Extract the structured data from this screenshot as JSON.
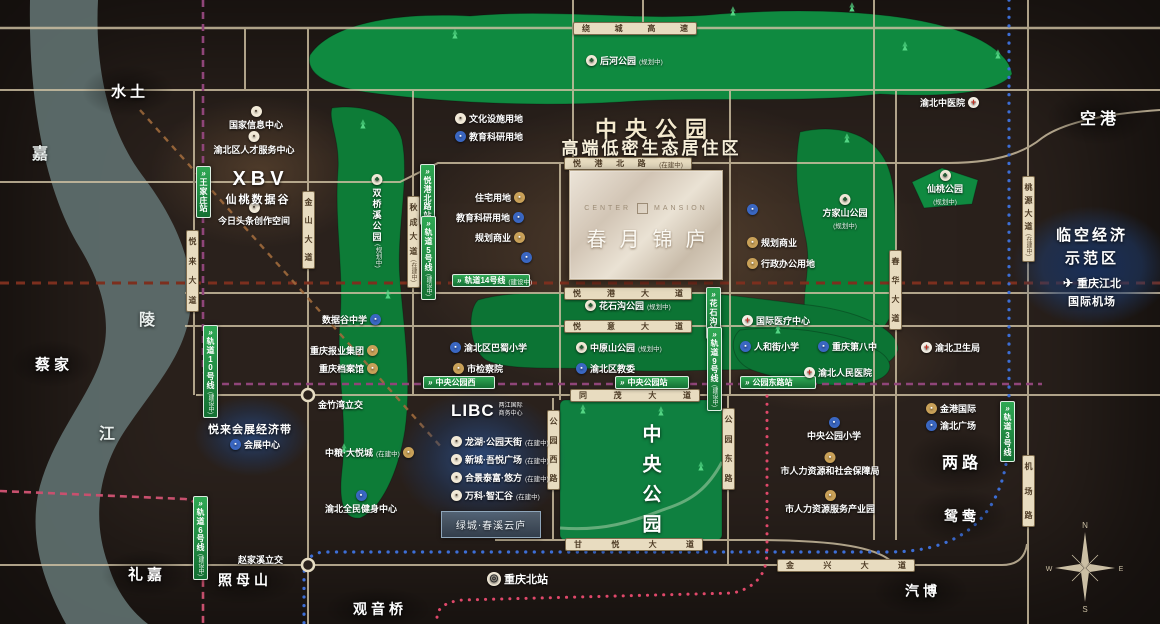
{
  "colors": {
    "background": "#2a211c",
    "road": "#cfc1a3",
    "road_label_bg": "#e8dcc0",
    "park_green": "#0d7c37",
    "park_green_bright": "#0f8a40",
    "river": "#5d6d6c",
    "metro_label_green": "#1d8a43",
    "line10_purple": "#8f4579",
    "line14_darkred": "#7c2f1e",
    "line6_pink": "#c8506e",
    "line3_blue": "#3d6ed6",
    "line9_red": "#e0486a",
    "construction_dash": "#a06a3c",
    "icon_blue": "#3a67c2",
    "icon_tan": "#c9a158",
    "zone_blue": "#2c508a",
    "cream": "#f3e8cd"
  },
  "headline": {
    "line1": "中央公园",
    "line2": "高端低密生态居住区"
  },
  "property": {
    "en_left": "CENTER",
    "en_right": "MANSION",
    "cn": "春月锦庐"
  },
  "xbv": {
    "title": "XBV",
    "subtitle": "仙桃数据谷"
  },
  "libc": {
    "title": "LIBC",
    "sub1": "两江国际",
    "sub2": "商务中心",
    "box": "绿城·春溪云庐",
    "items": [
      {
        "label": "龙湖·公园天街",
        "status": "(在建中)"
      },
      {
        "label": "新城·吾悦广场",
        "status": "(在建中)"
      },
      {
        "label": "合景泰富·悠方",
        "status": "(在建中)"
      },
      {
        "label": "万科·智汇谷",
        "status": "(在建中)"
      }
    ]
  },
  "linkong": {
    "line1": "临空经济",
    "line2": "示范区",
    "airport1": "重庆江北",
    "airport2": "国际机场"
  },
  "yuelai": {
    "title": "悦来会展经济带"
  },
  "central_park_title": "中央公园",
  "compass": {
    "n": "N",
    "s": "S",
    "e": "E",
    "w": "W"
  },
  "map": {
    "places": [
      {
        "t": "水土",
        "x": 128,
        "y": 91,
        "fs": 15,
        "hw": 92,
        "hh": 52
      },
      {
        "t": "蔡家",
        "x": 52,
        "y": 364,
        "fs": 15,
        "hw": 84,
        "hh": 48
      },
      {
        "t": "礼嘉",
        "x": 145,
        "y": 574,
        "fs": 15,
        "hw": 88,
        "hh": 48
      },
      {
        "t": "照母山",
        "x": 243,
        "y": 580,
        "fs": 14,
        "hw": 110,
        "hh": 50
      },
      {
        "t": "观音桥",
        "x": 378,
        "y": 609,
        "fs": 14,
        "hw": 108,
        "hh": 44
      },
      {
        "t": "空港",
        "x": 1098,
        "y": 117,
        "fs": 16,
        "hw": 104,
        "hh": 56
      },
      {
        "t": "两路",
        "x": 960,
        "y": 461,
        "fs": 16,
        "hw": 108,
        "hh": 64
      },
      {
        "t": "鸳鸯",
        "x": 960,
        "y": 516,
        "fs": 14,
        "hw": 96,
        "hh": 56
      },
      {
        "t": "汽博",
        "x": 921,
        "y": 591,
        "fs": 14,
        "hw": 96,
        "hh": 50
      }
    ],
    "river_chars": [
      {
        "t": "嘉",
        "x": 40,
        "y": 152
      },
      {
        "t": "陵",
        "x": 147,
        "y": 318
      },
      {
        "t": "江",
        "x": 107,
        "y": 432
      }
    ],
    "roads_h": [
      {
        "t": "绕城高速",
        "x": 573,
        "y": 22,
        "w": 124
      },
      {
        "t": "悦港北路",
        "x": 564,
        "y": 157,
        "w": 128,
        "sub": "(在建中)"
      },
      {
        "t": "悦港大道",
        "x": 564,
        "y": 287,
        "w": 128
      },
      {
        "t": "悦意大道",
        "x": 564,
        "y": 320,
        "w": 128
      },
      {
        "t": "同茂大道",
        "x": 570,
        "y": 389,
        "w": 130
      },
      {
        "t": "甘悦大道",
        "x": 565,
        "y": 538,
        "w": 138
      },
      {
        "t": "金兴大道",
        "x": 777,
        "y": 559,
        "w": 138
      }
    ],
    "roads_v": [
      {
        "t": "悦来大道",
        "x": 186,
        "y": 230,
        "h": 82
      },
      {
        "t": "金山大道",
        "x": 302,
        "y": 191,
        "h": 78
      },
      {
        "t": "秋成大道",
        "x": 407,
        "y": 196,
        "h": 92,
        "sub": "(在建中)"
      },
      {
        "t": "春华大道",
        "x": 889,
        "y": 250,
        "h": 80
      },
      {
        "t": "桃源大道",
        "x": 1022,
        "y": 176,
        "h": 86,
        "sub": "(在建中)"
      },
      {
        "t": "机场路",
        "x": 1022,
        "y": 455,
        "h": 72
      },
      {
        "t": "公园西路",
        "x": 547,
        "y": 410,
        "h": 80
      },
      {
        "t": "公园东路",
        "x": 722,
        "y": 408,
        "h": 82
      }
    ],
    "metro_h": [
      {
        "t": "轨道14号线",
        "x": 452,
        "y": 274,
        "w": 78,
        "sub": "(建设中)"
      },
      {
        "t": "中央公园西",
        "x": 423,
        "y": 376,
        "w": 72
      },
      {
        "t": "中央公园站",
        "x": 615,
        "y": 376,
        "w": 74
      },
      {
        "t": "公园东路站",
        "x": 740,
        "y": 376,
        "w": 76
      }
    ],
    "metro_v": [
      {
        "t": "王家庄站",
        "x": 196,
        "y": 166,
        "h": 46
      },
      {
        "t": "轨道10号线",
        "x": 203,
        "y": 325,
        "h": 50,
        "sub": "(建设中)"
      },
      {
        "t": "悦港北路站",
        "x": 420,
        "y": 164,
        "h": 46
      },
      {
        "t": "轨道5号线",
        "x": 421,
        "y": 216,
        "h": 50,
        "sub": "(建设中)"
      },
      {
        "t": "花石沟站",
        "x": 706,
        "y": 287,
        "h": 42
      },
      {
        "t": "轨道9号线",
        "x": 707,
        "y": 327,
        "h": 46,
        "sub": "(建设中)"
      },
      {
        "t": "轨道6号线",
        "x": 193,
        "y": 496,
        "h": 50,
        "sub": "(建设中)"
      },
      {
        "t": "轨道3号线",
        "x": 1000,
        "y": 401,
        "h": 44
      }
    ],
    "pois": [
      {
        "t": "国家信息中心",
        "x": 256,
        "y": 106,
        "i": "w",
        "s": "top"
      },
      {
        "t": "渝北区人才服务中心",
        "x": 254,
        "y": 131,
        "i": "w",
        "s": "top"
      },
      {
        "t": "今日头条创作空间",
        "x": 254,
        "y": 202,
        "i": "w",
        "s": "top"
      },
      {
        "t": "文化设施用地",
        "x": 455,
        "y": 112,
        "i": "w"
      },
      {
        "t": "教育科研用地",
        "x": 455,
        "y": 130,
        "i": "b"
      },
      {
        "t": "住宅用地",
        "x": 475,
        "y": 191,
        "i": "t",
        "s": "right"
      },
      {
        "t": "教育科研用地",
        "x": 456,
        "y": 211,
        "i": "b",
        "s": "right"
      },
      {
        "t": "规划商业",
        "x": 475,
        "y": 231,
        "i": "t",
        "s": "right"
      },
      {
        "t": "",
        "x": 521,
        "y": 251,
        "i": "b"
      },
      {
        "t": "",
        "x": 587,
        "y": 260,
        "i": "b"
      },
      {
        "t": "住宅用地",
        "x": 640,
        "y": 260,
        "i": "t",
        "s": "right"
      },
      {
        "t": "",
        "x": 747,
        "y": 203,
        "i": "b"
      },
      {
        "t": "规划商业",
        "x": 747,
        "y": 236,
        "i": "t"
      },
      {
        "t": "行政办公用地",
        "x": 747,
        "y": 257,
        "i": "t"
      },
      {
        "t": "渝北中医院",
        "x": 920,
        "y": 96,
        "i": "r",
        "s": "right"
      },
      {
        "t": "后河公园",
        "x": 586,
        "y": 54,
        "i": "p",
        "sub": "(规划中)"
      },
      {
        "t": "花石沟公园",
        "x": 585,
        "y": 299,
        "i": "p",
        "sub": "(规划中)"
      },
      {
        "t": "中原山公园",
        "x": 576,
        "y": 341,
        "i": "p",
        "sub": "(规划中)"
      },
      {
        "t": "渝北区教委",
        "x": 576,
        "y": 362,
        "i": "b"
      },
      {
        "t": "渝北区巴蜀小学",
        "x": 450,
        "y": 341,
        "i": "b"
      },
      {
        "t": "市检察院",
        "x": 453,
        "y": 362,
        "i": "t"
      },
      {
        "t": "数据谷中学",
        "x": 322,
        "y": 313,
        "i": "b",
        "s": "right"
      },
      {
        "t": "重庆报业集团",
        "x": 310,
        "y": 344,
        "i": "t",
        "s": "right"
      },
      {
        "t": "重庆档案馆",
        "x": 319,
        "y": 362,
        "i": "t",
        "s": "right"
      },
      {
        "t": "金竹湾立交",
        "x": 318,
        "y": 398,
        "i": "n"
      },
      {
        "t": "赵家溪立交",
        "x": 238,
        "y": 553,
        "i": "n"
      },
      {
        "t": "国际医疗中心",
        "x": 742,
        "y": 314,
        "i": "r"
      },
      {
        "t": "人和街小学",
        "x": 740,
        "y": 340,
        "i": "b"
      },
      {
        "t": "重庆第八中",
        "x": 818,
        "y": 340,
        "i": "b"
      },
      {
        "t": "渝北人民医院",
        "x": 804,
        "y": 366,
        "i": "r"
      },
      {
        "t": "渝北卫生局",
        "x": 921,
        "y": 341,
        "i": "r"
      },
      {
        "t": "金港国际",
        "x": 926,
        "y": 402,
        "i": "t"
      },
      {
        "t": "渝北广场",
        "x": 926,
        "y": 419,
        "i": "b"
      },
      {
        "t": "中央公园小学",
        "x": 834,
        "y": 417,
        "i": "b",
        "s": "top"
      },
      {
        "t": "市人力资源和社会保障局",
        "x": 830,
        "y": 452,
        "i": "t",
        "s": "top"
      },
      {
        "t": "市人力资源服务产业园",
        "x": 830,
        "y": 490,
        "i": "t",
        "s": "top"
      },
      {
        "t": "中粮·大悦城",
        "x": 325,
        "y": 446,
        "i": "t",
        "s": "right",
        "sub": "(在建中)"
      },
      {
        "t": "渝北全民健身中心",
        "x": 361,
        "y": 490,
        "i": "b",
        "s": "top"
      },
      {
        "t": "会展中心",
        "x": 230,
        "y": 438,
        "i": "b"
      },
      {
        "t": "重庆北站",
        "x": 487,
        "y": 572,
        "i": "tr",
        "fs": 11
      },
      {
        "t": "仙桃公园",
        "x": 945,
        "y": 170,
        "i": "p",
        "s": "top",
        "sub": "(规划中)"
      },
      {
        "t": "方家山公园",
        "x": 845,
        "y": 194,
        "i": "p",
        "s": "top",
        "sub": "(规划中)"
      },
      {
        "t": "双桥溪公园",
        "x": 377,
        "y": 174,
        "i": "p",
        "s": "vert",
        "sub": "(规划中)"
      }
    ],
    "trees": [
      [
        455,
        36
      ],
      [
        733,
        13
      ],
      [
        852,
        9
      ],
      [
        905,
        48
      ],
      [
        998,
        56
      ],
      [
        363,
        126
      ],
      [
        388,
        296
      ],
      [
        344,
        450
      ],
      [
        583,
        411
      ],
      [
        661,
        413
      ],
      [
        701,
        468
      ],
      [
        778,
        331
      ],
      [
        847,
        140
      ]
    ]
  }
}
